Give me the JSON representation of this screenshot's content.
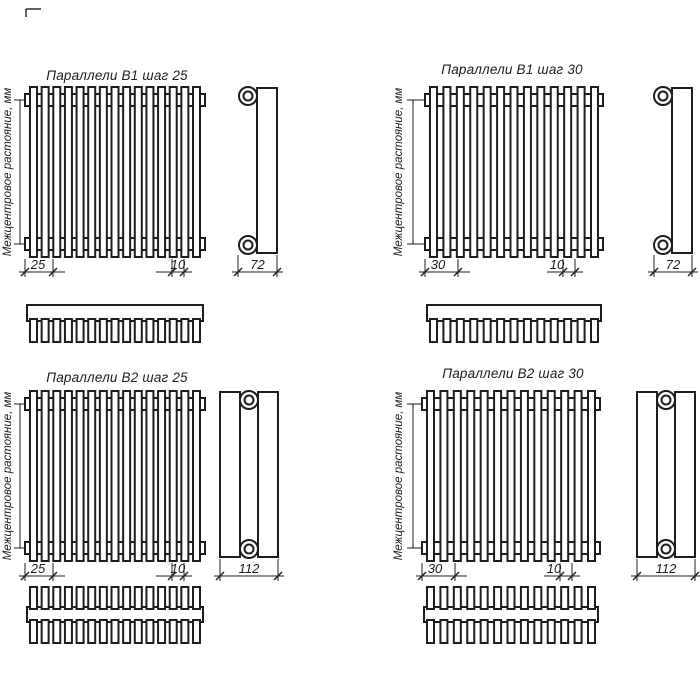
{
  "page": {
    "background": "#ffffff",
    "line_color": "#1d1d1d"
  },
  "drawing": {
    "axis_label": "Межцентровое растояние, мм",
    "quadrants": [
      {
        "title": "Параллели В1 шаг 25",
        "series": "В1",
        "pitch": "25",
        "gap": "10",
        "depth": "72",
        "tube_count": 15,
        "rows": 1
      },
      {
        "title": "Параллели В1 шаг 30",
        "series": "В1",
        "pitch": "30",
        "gap": "10",
        "depth": "72",
        "tube_count": 13,
        "rows": 1
      },
      {
        "title": "Параллели В2 шаг 25",
        "series": "В2",
        "pitch": "25",
        "gap": "10",
        "depth": "112",
        "tube_count": 15,
        "rows": 2
      },
      {
        "title": "Параллели В2 шаг 30",
        "series": "В2",
        "pitch": "30",
        "gap": "10",
        "depth": "112",
        "tube_count": 13,
        "rows": 2
      }
    ]
  }
}
